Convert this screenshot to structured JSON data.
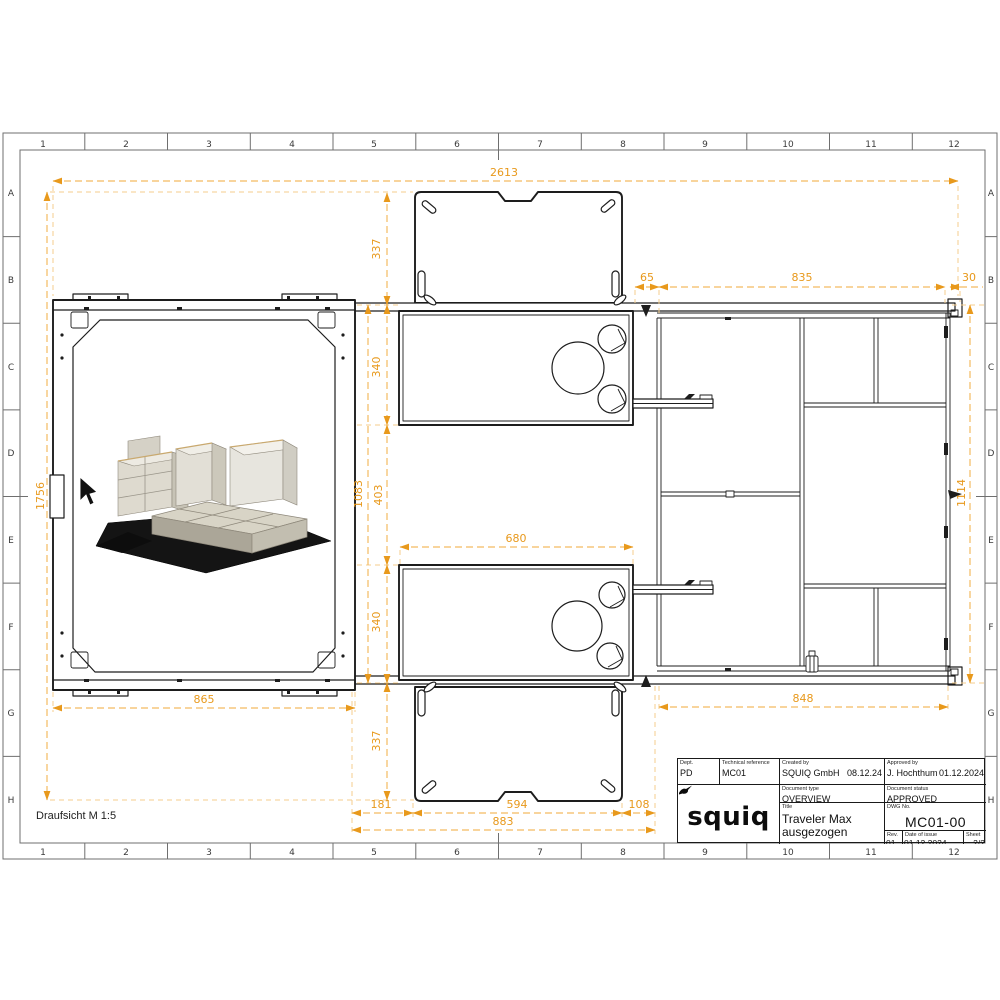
{
  "grid": {
    "columns": [
      "1",
      "2",
      "3",
      "4",
      "5",
      "6",
      "7",
      "8",
      "9",
      "10",
      "11",
      "12"
    ],
    "rows": [
      "A",
      "B",
      "C",
      "D",
      "E",
      "F",
      "G",
      "H"
    ]
  },
  "view": {
    "label": "Draufsicht M 1:5"
  },
  "dims": {
    "total_width": "2613",
    "total_height": "1756",
    "right_height": "1114",
    "flap_top": "337",
    "drawer_top": "340",
    "mid_gap": "403",
    "body_height": "1083",
    "drawer_bottom": "340",
    "flap_bottom": "337",
    "offset_left": "65",
    "frame_span": "835",
    "offset_right": "30",
    "drawer_width": "680",
    "panel_width": "865",
    "frame_width": "848",
    "seg_181": "181",
    "seg_594": "594",
    "seg_108": "108",
    "flap_total": "883"
  },
  "title_block": {
    "dept_label": "Dept.",
    "dept": "PD",
    "tech_ref_label": "Technical reference",
    "tech_ref": "MC01",
    "created_by_label": "Created by",
    "created_by": "SQUIQ GmbH",
    "created_date": "08.12.24",
    "approved_by_label": "Approved by",
    "approved_by": "J. Hochthum",
    "approved_date": "01.12.2024",
    "doc_type_label": "Document type",
    "doc_type": "OVERVIEW",
    "doc_status_label": "Document status",
    "doc_status": "APPROVED",
    "title_label": "Title",
    "title_line1": "Traveler Max",
    "title_line2": "ausgezogen",
    "dwg_label": "DWG No.",
    "dwg_no": "MC01-00",
    "rev_label": "Rev.",
    "rev": "01",
    "issue_label": "Date of issue",
    "issue_date": "01.12.2024",
    "sheet_label": "Sheet",
    "sheet": "2/2",
    "logo": "squiq"
  },
  "colors": {
    "dimension_text": "#E8991C",
    "dimension_line": "#F4BB61",
    "extension_line": "#F6CE8C",
    "drawing_line": "#1D1D1D"
  }
}
